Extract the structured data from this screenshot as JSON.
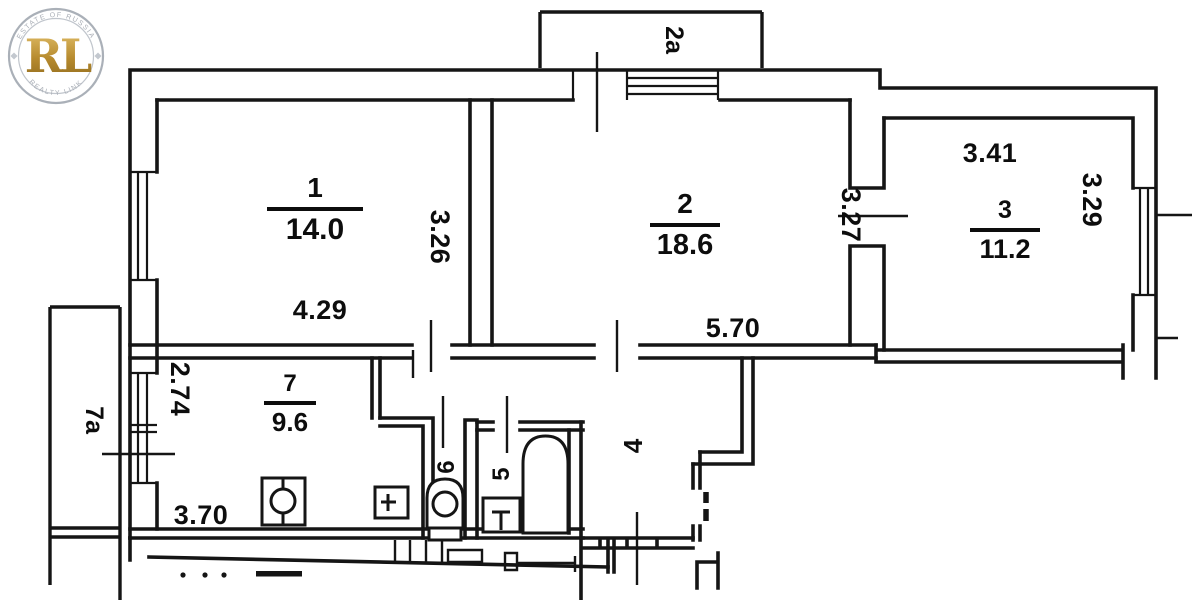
{
  "plan_title": "apartment-floor-plan",
  "rooms": {
    "r1": {
      "number": "1",
      "area": "14.0",
      "width": "4.29",
      "depth": "3.26"
    },
    "r2": {
      "number": "2",
      "area": "18.6",
      "width": "5.70",
      "depth": "3.27"
    },
    "r3": {
      "number": "3",
      "area": "11.2",
      "width": "3.41",
      "depth": "3.29"
    },
    "r7": {
      "number": "7",
      "area": "9.6",
      "width": "3.70",
      "depth": "2.74"
    },
    "r4": {
      "number": "4"
    },
    "r5": {
      "number": "5"
    },
    "r6": {
      "number": "6"
    }
  },
  "balconies": {
    "top": "2a",
    "left": "7a"
  },
  "watermark": {
    "initials": "RL",
    "arc_top": "ESTATE OF RUSSIA",
    "arc_bottom": "REALTY LINK",
    "gold_light": "#e3c06a",
    "gold_mid": "#b68a2e",
    "gold_dark": "#8f6a1d"
  },
  "ink": "#151515"
}
